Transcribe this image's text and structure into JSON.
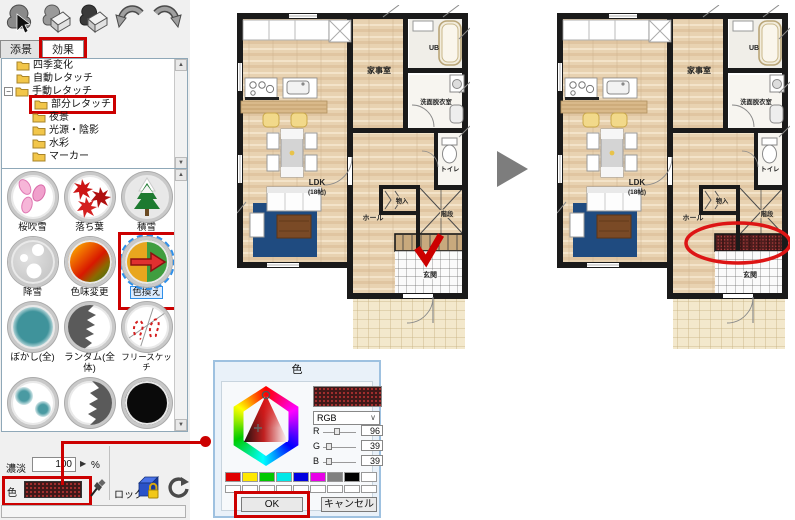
{
  "accent_red": "#cc0000",
  "toolbar": {
    "icons": [
      "tree-select-icon",
      "retouch-eraser-icon",
      "retouch-apply-icon",
      "undo-icon",
      "redo-icon"
    ]
  },
  "tabs": {
    "scenery": "添景",
    "effect": "効果"
  },
  "tree": {
    "items": [
      {
        "label": "四季変化"
      },
      {
        "label": "自動レタッチ"
      },
      {
        "label": "手動レタッチ"
      },
      {
        "label": "部分レタッチ"
      },
      {
        "label": "夜景"
      },
      {
        "label": "光源・陰影"
      },
      {
        "label": "水彩"
      },
      {
        "label": "マーカー"
      }
    ]
  },
  "effects": {
    "items": [
      {
        "label": "桜吹雪",
        "icon": "sakura-petals-icon"
      },
      {
        "label": "落ち葉",
        "icon": "fallen-leaves-icon"
      },
      {
        "label": "積雪",
        "icon": "snow-tree-icon"
      },
      {
        "label": "降雪",
        "icon": "snowfall-icon"
      },
      {
        "label": "色味変更",
        "icon": "tint-change-icon"
      },
      {
        "label": "色換え",
        "icon": "recolor-icon"
      },
      {
        "label": "ぼかし(全)",
        "icon": "blur-all-icon"
      },
      {
        "label": "ランダム(全体)",
        "icon": "random-all-icon"
      },
      {
        "label": "フリースケッチ",
        "icon": "free-sketch-icon"
      }
    ],
    "selected": "色換え"
  },
  "controls": {
    "density_label": "濃淡",
    "density_value": "100",
    "unit": "%",
    "color_label": "色",
    "current_color": "#602727",
    "lock_label": "ロック"
  },
  "plan": {
    "rooms": {
      "kaji": "家事室",
      "ub": "UB",
      "senmen": "洗面脱衣室",
      "toilet": "トイレ",
      "ldk": "LDK",
      "ldk_size": "(18帖)",
      "hall": "ホール",
      "mono": "物入",
      "kaidan": "階段",
      "genkan": "玄関"
    },
    "annotation": {
      "check_color": "#cc0000",
      "ellipse_color": "#dd1515",
      "recolored_steps": "#4e1d1d"
    }
  },
  "dialog": {
    "title": "色",
    "mode": "RGB",
    "labels": {
      "r": "R",
      "g": "G",
      "b": "B"
    },
    "values": {
      "r": "96",
      "g": "39",
      "b": "39"
    },
    "ok": "OK",
    "cancel": "キャンセル",
    "selected_color": "#602727",
    "palette": [
      "#e00000",
      "#ffe800",
      "#00c800",
      "#00e8e8",
      "#0000e0",
      "#e800e8",
      "#808080",
      "#000000",
      "#ffffff"
    ]
  }
}
